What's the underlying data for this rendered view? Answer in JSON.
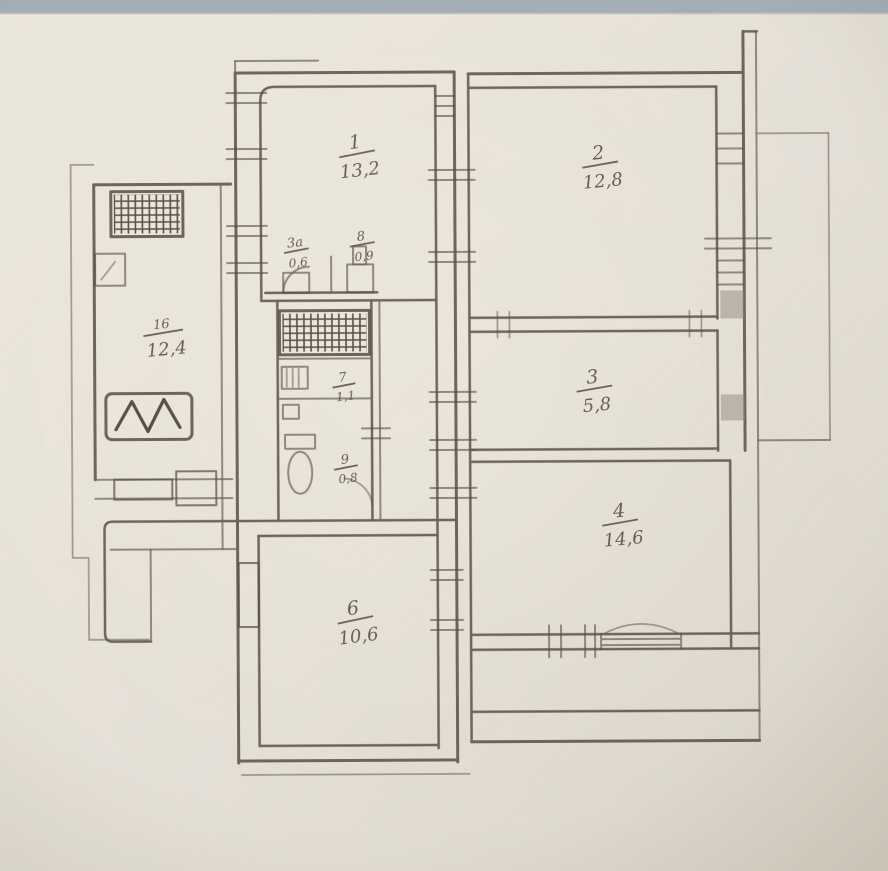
{
  "plan": {
    "labels": {
      "room_top": {
        "number": "1",
        "area": "13,2"
      },
      "room_topright": {
        "number": "2",
        "area": "12,8"
      },
      "room_midright": {
        "number": "3",
        "area": "5,8"
      },
      "room_botright": {
        "number": "4",
        "area": "14,6"
      },
      "room_botcenter": {
        "number": "6",
        "area": "10,6"
      },
      "left_room": {
        "number": "16",
        "area": "12,4"
      },
      "closet_a": {
        "number": "3а",
        "area": "0,6"
      },
      "closet_b": {
        "number": "8",
        "area": "0,9"
      },
      "bath": {
        "number": "7",
        "area": "1,1"
      },
      "wc": {
        "number": "9",
        "area": "0,8"
      }
    },
    "colors": {
      "paper": "#ebe6dc",
      "ink": "#584f43",
      "hatch_ink": "#3e372d",
      "photo_strip": "#a7b0ba"
    }
  }
}
